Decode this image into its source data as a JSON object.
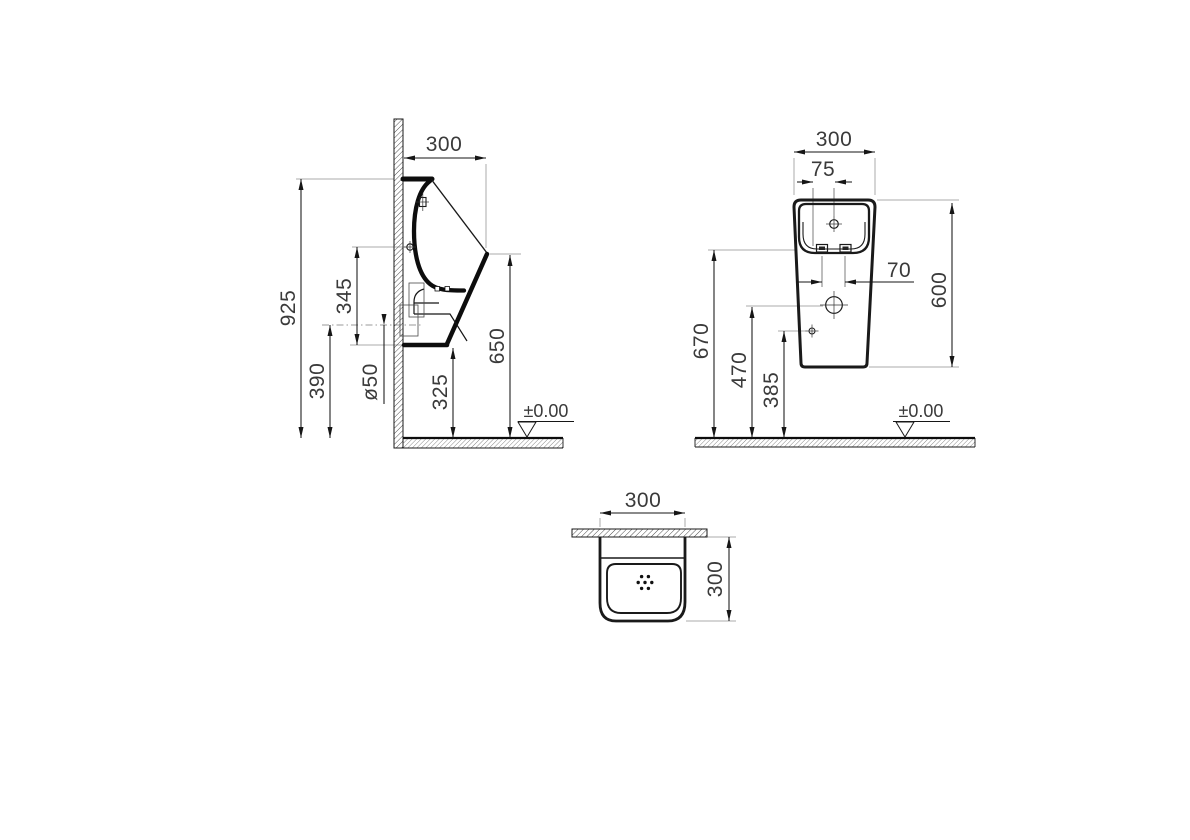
{
  "colors": {
    "line": "#161616",
    "thick_line": "#0d0d0d",
    "extension_line": "#ababab",
    "text": "#3a3a3a",
    "background": "#ffffff"
  },
  "side_view": {
    "dims": {
      "depth": "300",
      "overall_height": "925",
      "inlet_height_span": "345",
      "outlet_height": "390",
      "outlet_diameter": "ø50",
      "bottom_clearance": "325",
      "spout_height": "650"
    },
    "floor_level": "±0.00"
  },
  "front_view": {
    "dims": {
      "width": "300",
      "inlet_offset": "75",
      "fixing_hole_spacing": "70",
      "body_height": "600",
      "fixing_hole_height": "670",
      "drain_height": "470",
      "side_fixing_height": "385"
    },
    "floor_level": "±0.00"
  },
  "top_view": {
    "dims": {
      "width": "300",
      "depth": "300"
    }
  }
}
